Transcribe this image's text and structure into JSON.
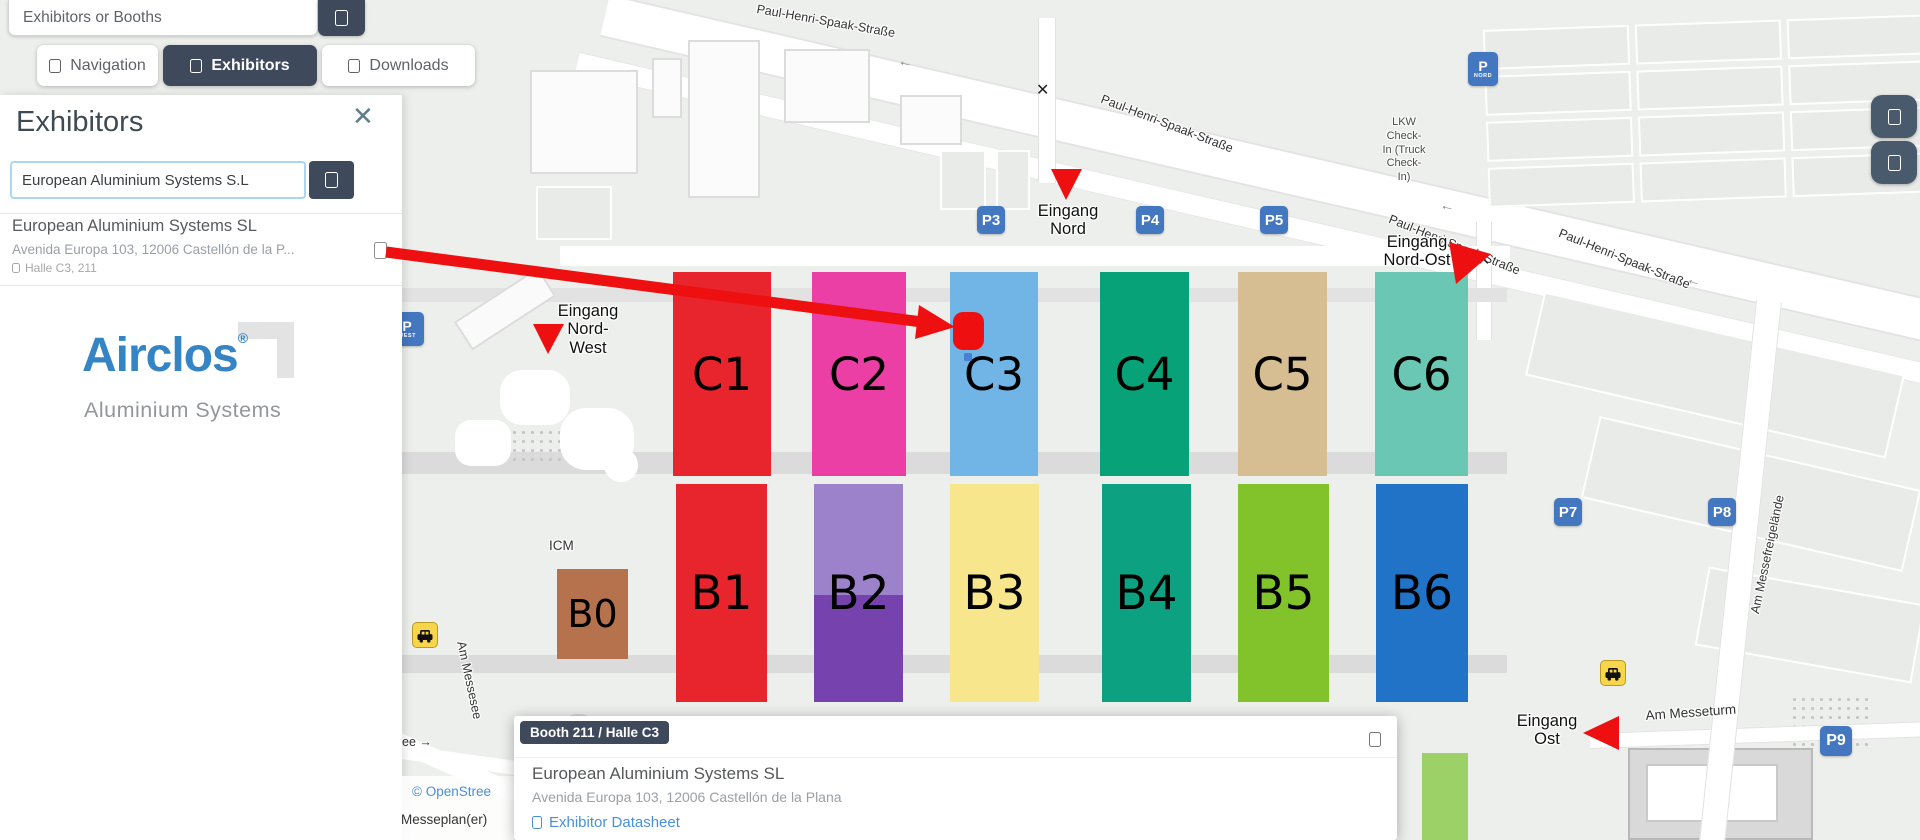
{
  "colors": {
    "navy": "#3e4a5c",
    "red": "#ee1010",
    "link_blue": "#4a90d9",
    "parking_blue": "#4377c0",
    "taxi_yellow": "#f7d64b",
    "map_bg": "#edefec",
    "brand_blue": "#3585c5"
  },
  "topbar": {
    "search_placeholder": "Exhibitors or Booths"
  },
  "tabs": [
    {
      "label": "Navigation"
    },
    {
      "label": "Exhibitors"
    },
    {
      "label": "Downloads"
    }
  ],
  "panel": {
    "title": "Exhibitors",
    "close": "✕",
    "search_value": "European Aluminium Systems S.L",
    "result": {
      "name": "European Aluminium Systems SL",
      "address": "Avenida Europa 103, 12006 Castellón de la P...",
      "location": "Halle C3, 211"
    },
    "logo": {
      "brand": "Airclos",
      "registered": "®",
      "tagline": "Aluminium Systems"
    }
  },
  "map": {
    "halls": [
      {
        "label": "C1",
        "color": "#e8252c"
      },
      {
        "label": "C2",
        "color": "#ec3fa5"
      },
      {
        "label": "C3",
        "color": "#70b5e6"
      },
      {
        "label": "C4",
        "color": "#07a278"
      },
      {
        "label": "C5",
        "color": "#d6bd92"
      },
      {
        "label": "C6",
        "color": "#69c7b3"
      },
      {
        "label": "B1",
        "color": "#e8252c"
      },
      {
        "label": "B2",
        "color": "#9c82ca"
      },
      {
        "label": "B3",
        "color": "#f8e68d"
      },
      {
        "label": "B4",
        "color": "#0ba181"
      },
      {
        "label": "B5",
        "color": "#82c32c"
      },
      {
        "label": "B6",
        "color": "#2173c8"
      },
      {
        "label": "B0",
        "color": "#b5724d"
      },
      {
        "label": "",
        "color": "#9bd167"
      }
    ],
    "hall_b2_lower_color": "#7643ae",
    "entrances": [
      {
        "lines": [
          "Eingang",
          "Nord"
        ]
      },
      {
        "lines": [
          "Eingang",
          "Nord-",
          "West"
        ]
      },
      {
        "lines": [
          "Eingang",
          "Nord-Ost"
        ]
      },
      {
        "lines": [
          "Eingang",
          "Ost"
        ]
      }
    ],
    "streets": {
      "phs": "Paul-Henri-Spaak-Straße",
      "am_messeturm": "Am Messeturm",
      "am_messesee": "Am Messesee",
      "am_messefreigelaende": "Am Messefreigelände",
      "see_fragment": "ee →"
    },
    "labels": {
      "icm": "ICM",
      "lkw_lines": [
        "LKW",
        "Check-",
        "In (Truck",
        "Check-",
        "In)"
      ]
    },
    "parking": {
      "badges": [
        "P3",
        "P4",
        "P5",
        "P7",
        "P8",
        "P9"
      ],
      "nord": {
        "p": "P",
        "sub": "NORD"
      },
      "west": {
        "p": "P",
        "sub": "WEST"
      }
    },
    "symbols": {
      "cross": "✕",
      "road_arrow": "←"
    }
  },
  "popup": {
    "badge": "Booth 211 / Halle C3",
    "name": "European Aluminium Systems SL",
    "address": "Avenida Europa 103, 12006 Castellón de la Plana",
    "datasheet": "Exhibitor Datasheet"
  },
  "attribution": {
    "osm": "© OpenStree",
    "brand": "Messeplan(er)"
  }
}
